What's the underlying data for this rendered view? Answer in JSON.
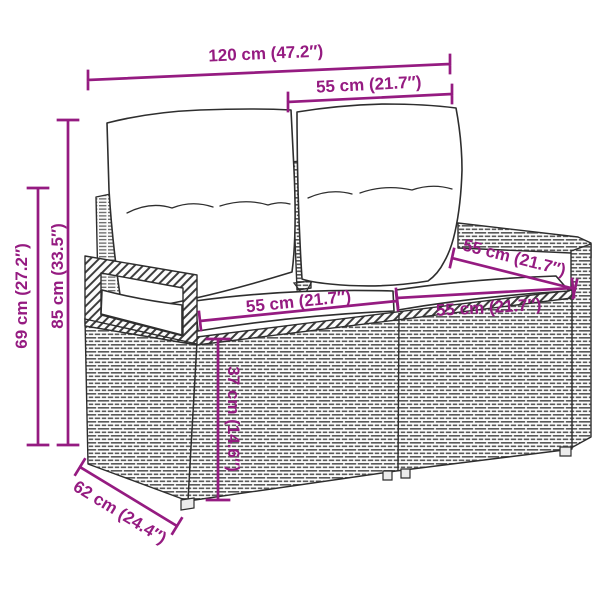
{
  "diagram": {
    "colors": {
      "accent": "#951B81",
      "outline": "#2E2E2E",
      "weave": "#5A5A5A"
    },
    "dimensions": {
      "overall_width": "120 cm (47.2″)",
      "backrest_width": "55 cm (21.7″)",
      "total_height": "85 cm (33.5″)",
      "armrest_height": "69 cm (27.2″)",
      "seat_width_left": "55 cm (21.7″)",
      "seat_depth": "55 cm (21.7″)",
      "seat_width_right": "55 cm (21.7″)",
      "seat_height": "37 cm (14.6″)",
      "depth": "62 cm (24.4″)"
    }
  }
}
